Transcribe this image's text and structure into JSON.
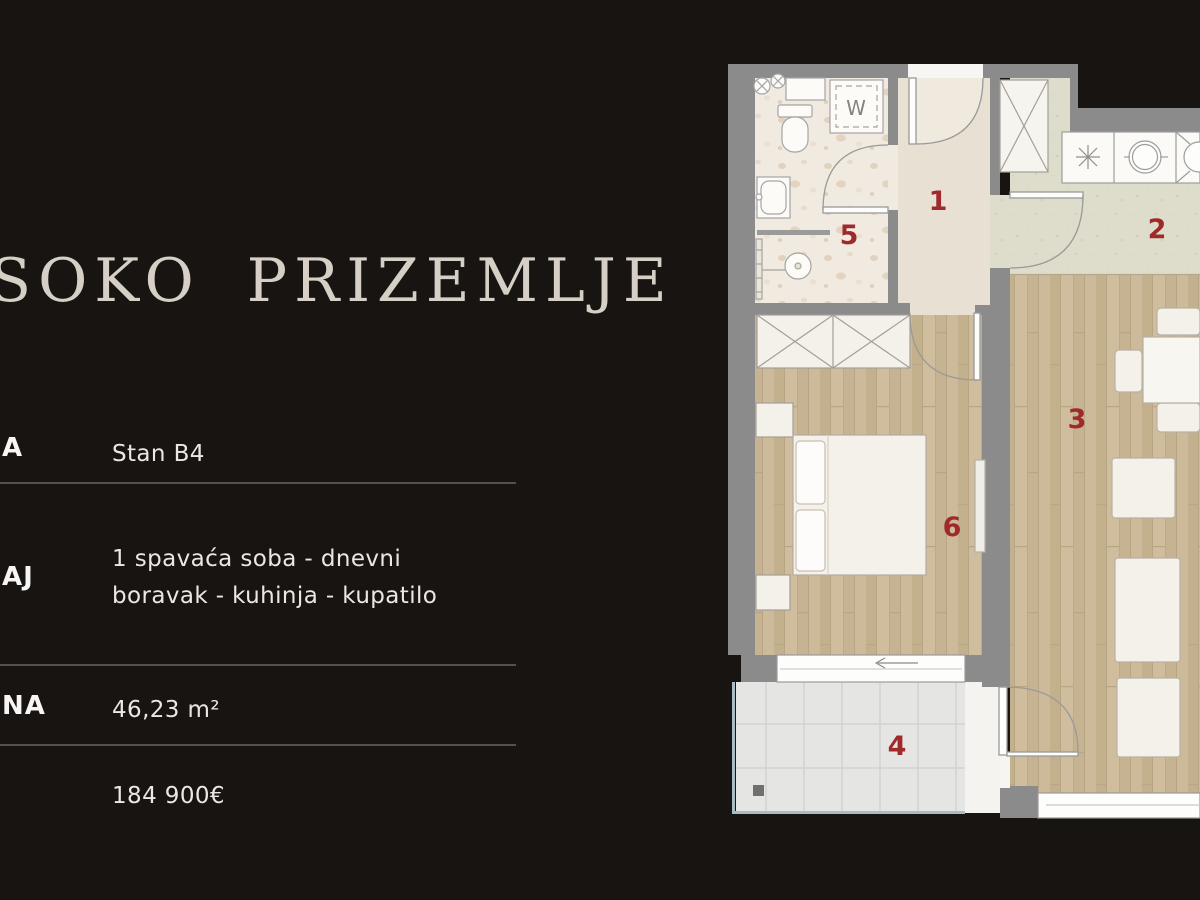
{
  "title": "SOKO PRIZEMLJE",
  "panel": {
    "rows": [
      {
        "label": "A",
        "value": "Stan B4"
      },
      {
        "label": "AJ",
        "value": "1 spavaća soba - dnevni boravak - kuhinja - kupatilo"
      },
      {
        "label": "NA",
        "value": "46,23 m²"
      },
      {
        "label": "",
        "value": "184 900€"
      }
    ]
  },
  "floorplan": {
    "rooms": [
      {
        "number": "1",
        "name": "hallway"
      },
      {
        "number": "2",
        "name": "kitchen-dining"
      },
      {
        "number": "3",
        "name": "living-room"
      },
      {
        "number": "4",
        "name": "balcony"
      },
      {
        "number": "5",
        "name": "bathroom"
      },
      {
        "number": "6",
        "name": "bedroom"
      }
    ],
    "washer_label": "W"
  },
  "colors": {
    "background": "#181412",
    "title": "#d6cfc5",
    "accent_red": "#9e2a2b",
    "wall_gray": "#8b8b8b",
    "divider": "#55514b"
  }
}
